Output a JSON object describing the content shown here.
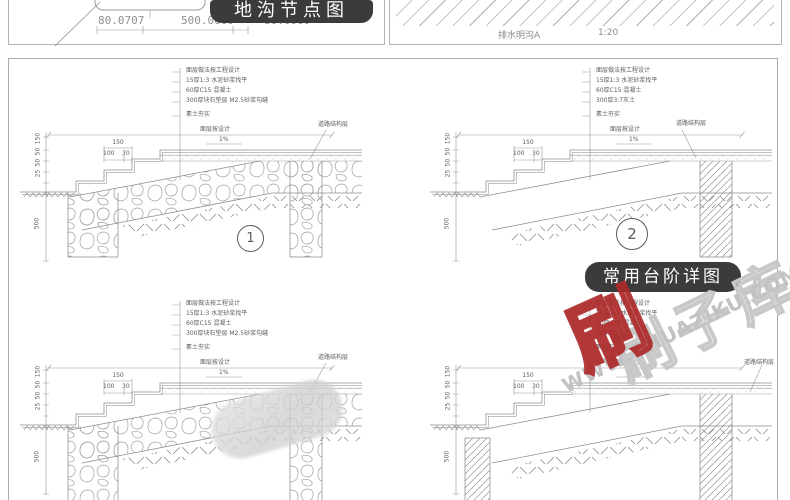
{
  "top_left": {
    "dims": [
      "80.0707",
      "500.0000",
      "80.0000"
    ],
    "badge": "地沟节点图"
  },
  "top_right": {
    "caption": "排水明沟A",
    "scale": "1:20"
  },
  "main": {
    "badge": "常用台阶详图",
    "details": [
      {
        "number": "1",
        "callouts": [
          "面层做法按工程设计",
          "15厚1:3 水泥砂浆找平",
          "60厚C15 混凝土",
          "300厚块石垫层 M2.5砂浆勾缝",
          "素土夯实"
        ],
        "width_label": "面层按设计",
        "slope": "1%",
        "right_label": "道路结构层",
        "dim_tread": "150",
        "dim_a": "100",
        "dim_b": "30",
        "dims_v": [
          "150",
          "50",
          "50",
          "25"
        ],
        "dim_depth": "500"
      },
      {
        "number": "2",
        "callouts": [
          "面层做法按工程设计",
          "15厚1:3 水泥砂浆找平",
          "60厚C15 混凝土",
          "300厚3:7灰土",
          "素土夯实"
        ],
        "width_label": "面层按设计",
        "slope": "1%",
        "right_label": "道路结构层",
        "dim_tread": "150",
        "dim_a": "100",
        "dim_b": "30",
        "dims_v": [
          "150",
          "50",
          "50",
          "25"
        ],
        "dim_depth": "500"
      },
      {
        "callouts": [
          "面层做法按工程设计",
          "15厚1:3 水泥砂浆找平",
          "60厚C15 混凝土",
          "300厚块石垫层 M2.5砂浆勾缝",
          "素土夯实"
        ],
        "width_label": "面层按设计",
        "slope": "1%",
        "right_label": "道路结构层",
        "dim_tread": "150",
        "dim_a": "100",
        "dim_b": "30",
        "dims_v": [
          "150",
          "50",
          "50",
          "25"
        ],
        "dim_depth": "500"
      },
      {
        "callouts": [
          "面层做法按工程设计",
          "15厚1:3 水泥砂浆找平",
          "60厚C15 混凝土",
          "300厚3:7灰土",
          "素土夯实"
        ],
        "width_label": "面层按设计",
        "slope": "1%",
        "right_label": "道路结构层",
        "dim_tread": "150",
        "dim_a": "100",
        "dim_b": "30",
        "dims_v": [
          "150",
          "50",
          "50",
          "25"
        ],
        "dim_depth": "500"
      }
    ]
  },
  "watermark": {
    "logo": "刷",
    "brand": "刷子库",
    "url": "WWW.SHUAZIKU.COM"
  }
}
